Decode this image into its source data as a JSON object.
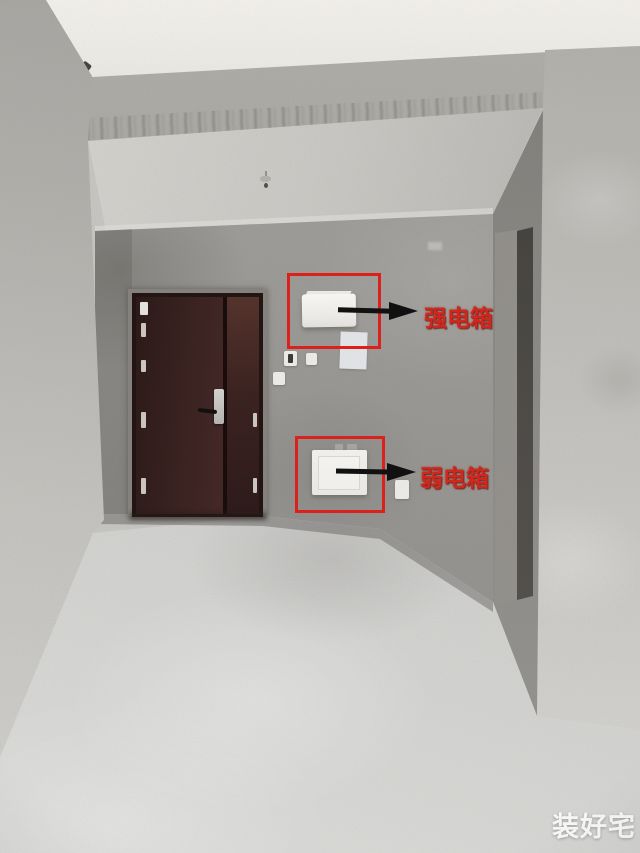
{
  "photo": {
    "annotations": {
      "strong_box_label": "强电箱",
      "weak_box_label": "弱电箱",
      "highlight_color": "#e2211c",
      "label_color": "#d6281c",
      "arrow_color": "#111111"
    },
    "watermark": {
      "text": "装好宅",
      "color": "#ffffff"
    }
  }
}
